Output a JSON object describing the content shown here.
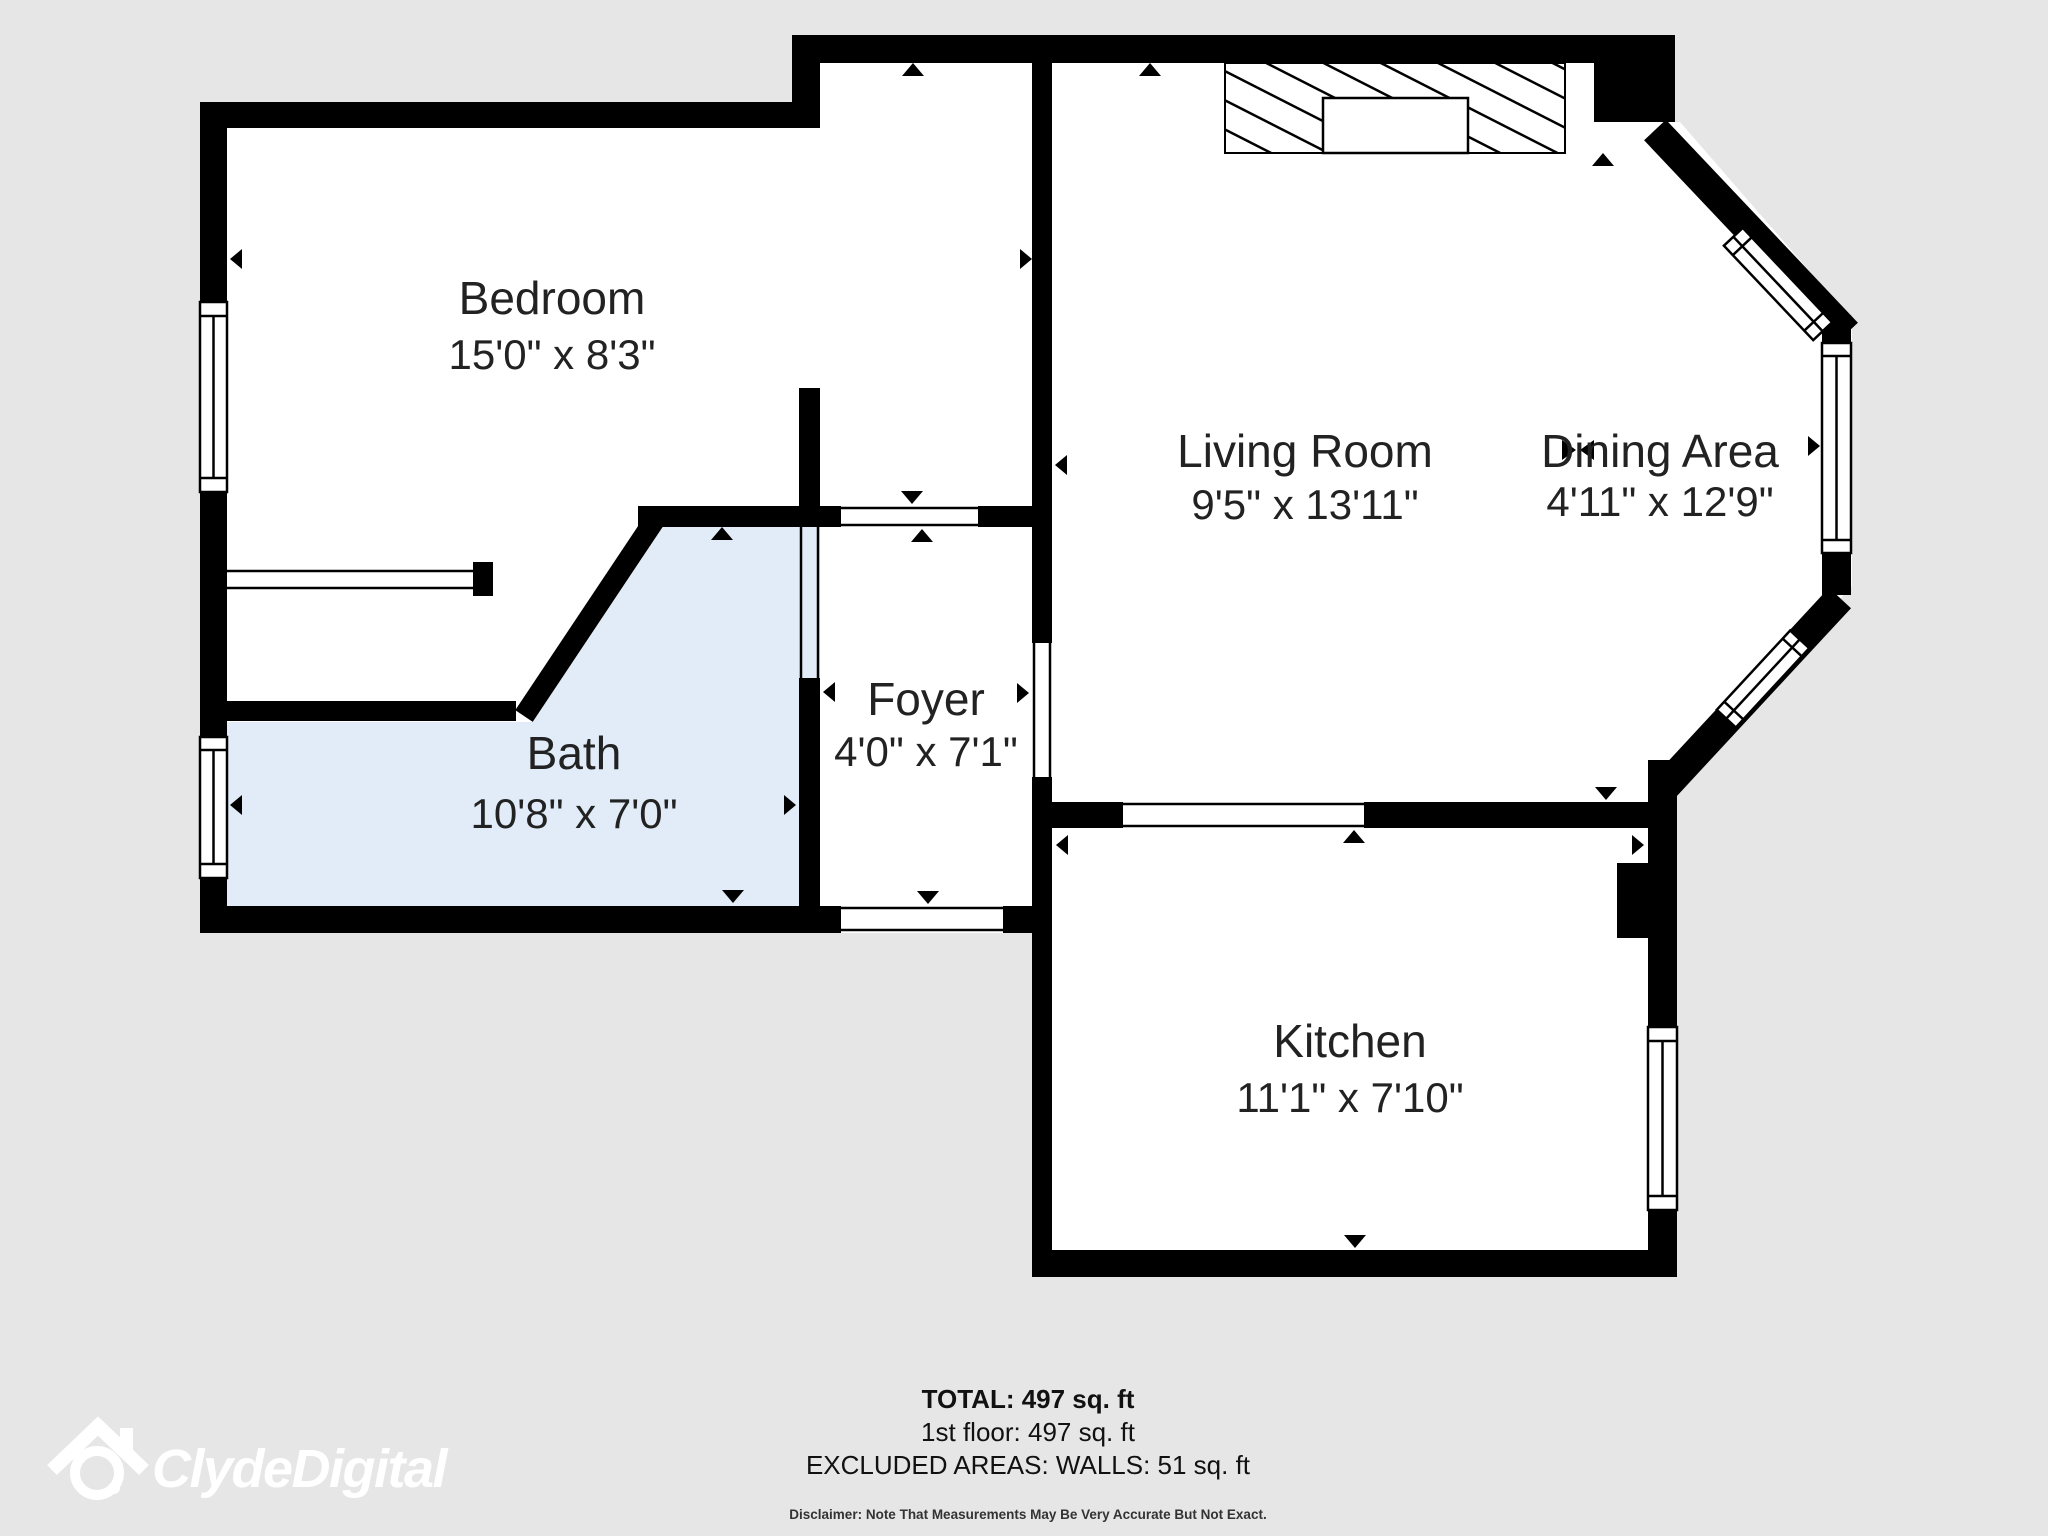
{
  "rooms": {
    "bedroom": {
      "name": "Bedroom",
      "dims": "15'0\" x 8'3\""
    },
    "living_room": {
      "name": "Living Room",
      "dims": "9'5\" x 13'11\""
    },
    "dining_area": {
      "name": "Dining Area",
      "dims": "4'11\" x 12'9\""
    },
    "bath": {
      "name": "Bath",
      "dims": "10'8\" x 7'0\""
    },
    "foyer": {
      "name": "Foyer",
      "dims": "4'0\" x 7'1\""
    },
    "kitchen": {
      "name": "Kitchen",
      "dims": "11'1\" x 7'10\""
    }
  },
  "footer": {
    "total": "TOTAL: 497 sq. ft",
    "floor": "1st floor: 497 sq. ft",
    "excluded": "EXCLUDED AREAS: WALLS: 51 sq. ft",
    "disclaimer": "Disclaimer: Note That Measurements May Be Very Accurate But Not Exact."
  },
  "logo": {
    "brand": "ClydeDigital"
  },
  "colors": {
    "background": "#e6e6e7",
    "wall": "#000000",
    "room_fill": "#ffffff",
    "bath_fill": "#e1ecf8",
    "label_text": "#222222",
    "logo": "#ffffff"
  }
}
